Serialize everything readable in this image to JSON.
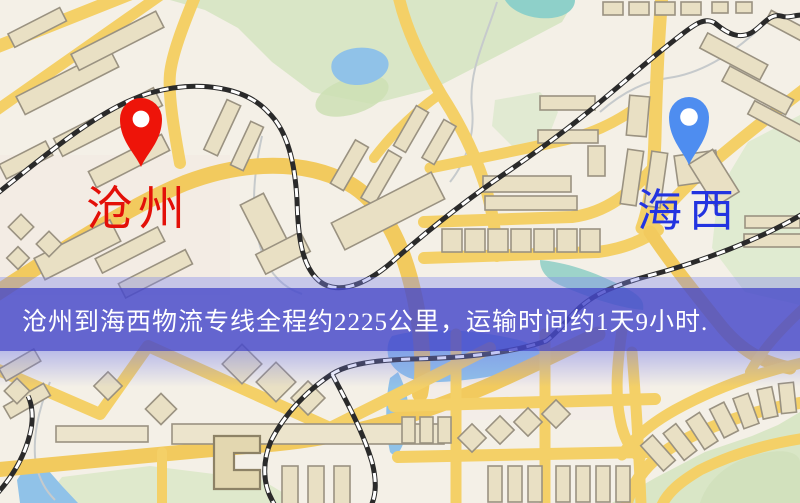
{
  "banner": {
    "text": "沧州到海西物流专线全程约2225公里，运输时间约1天9小时.",
    "background_color": "#4a4acb",
    "text_color": "#ffffff"
  },
  "markers": {
    "origin": {
      "label": "沧州",
      "label_color": "#e31008",
      "pin_color": "#ee1409"
    },
    "destination": {
      "label": "海西",
      "label_color": "#2334e0",
      "pin_color": "#4e8df0"
    }
  },
  "map_palette": {
    "background": "#f4f0e7",
    "road": "#f4d067",
    "building_fill": "#e9e0c4",
    "building_stroke": "#9a9281",
    "park": "#d9e6c6",
    "water": "#90c2e8",
    "water_teal": "#8ed0c9",
    "railway": "#2a2a2a"
  }
}
